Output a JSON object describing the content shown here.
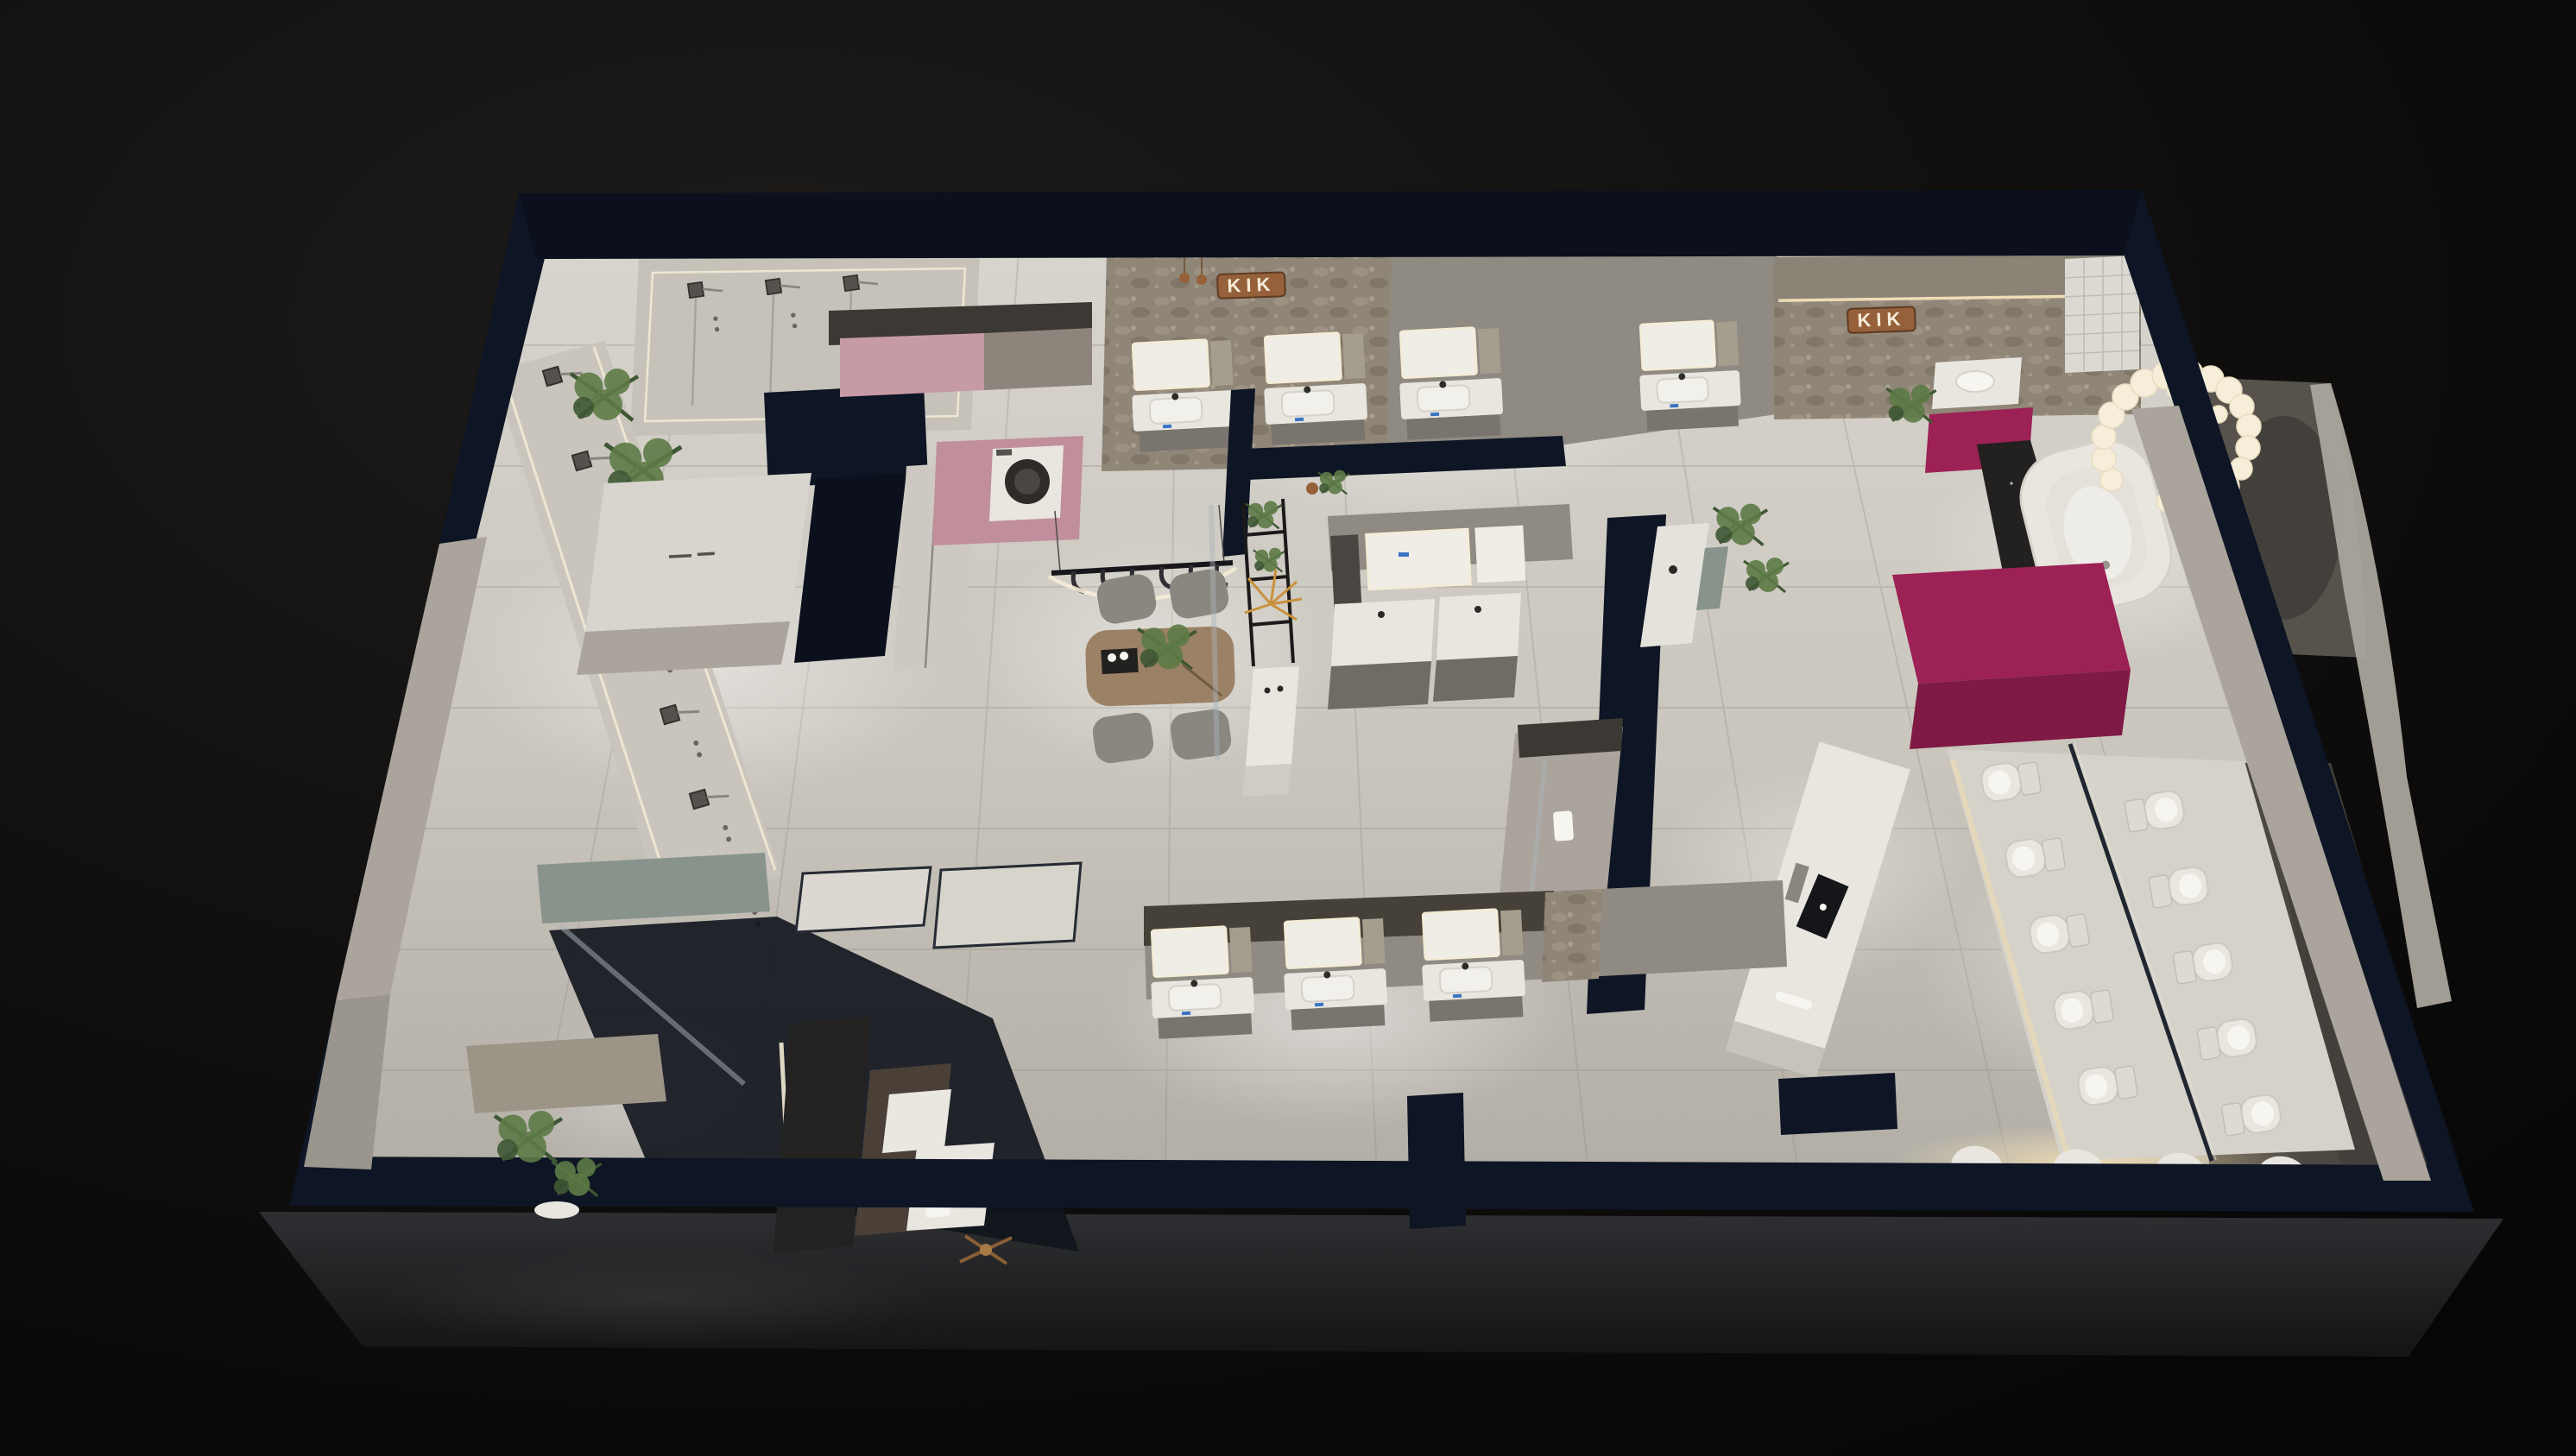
{
  "scene": {
    "title": "3D dollhouse-view render of a KIK bathroom-fixtures showroom",
    "style": "photorealistic top-down interior render, dark night surround",
    "brand": "KIK"
  },
  "branding": {
    "logo_text": "KIK",
    "plaques": [
      {
        "location": "top-center travertine feature wall",
        "material": "copper"
      },
      {
        "location": "right-wing travertine wall above bathtub area",
        "material": "copper"
      }
    ]
  },
  "colors": {
    "navy": "#0e1524",
    "navy2": "#0b101c",
    "wallLight": "#aaa49c",
    "wallMid": "#8f8a82",
    "wallDark": "#3c3833",
    "stone": "#8f8678",
    "white": "#e9e6e0",
    "whiteBright": "#f7f5f0",
    "mirror": "#efede6",
    "mat": "#4b4741",
    "magenta": "#9c2154",
    "magentaDark": "#7e1a44",
    "pink": "#c79ba6",
    "copper": "#95603a",
    "logoText": "#f5ecd9",
    "wood": "#9b8166",
    "chair": "#8a8781",
    "green": "#5d7a46",
    "greenD": "#3e5733",
    "palm": "#c8913c",
    "teal": "#87938b",
    "screen": "#15161a",
    "tag": "#3b74c4",
    "led": "#f5ecd6",
    "glass": "#aab4b8",
    "tileLine": "#8e897f",
    "floor": "#cfccc4",
    "apron": "#27282a",
    "ground": "#0d0d0c"
  },
  "zones": [
    {
      "id": "zone-shower-display",
      "label": "shower & faucet display walls"
    },
    {
      "id": "zone-reception",
      "label": "reception desk"
    },
    {
      "id": "zone-laundry",
      "label": "laundry nook with washing machine"
    },
    {
      "id": "zone-stone-wall-vanities",
      "label": "vanity row on travertine wall"
    },
    {
      "id": "zone-dining-table",
      "label": "wood consult table with faucet rail"
    },
    {
      "id": "zone-vanity-islands",
      "label": "center vanity islands"
    },
    {
      "id": "zone-consult-island",
      "label": "white display island with screen"
    },
    {
      "id": "zone-bathtub",
      "label": "freestanding tub with bulb chandelier"
    },
    {
      "id": "zone-toilet-platform",
      "label": "smart-toilet display platform"
    },
    {
      "id": "zone-bottom-vanities",
      "label": "lower vanity display row"
    },
    {
      "id": "zone-bath-rooms",
      "label": "mock bathroom rooms, lower left"
    },
    {
      "id": "zone-entrance",
      "label": "entrance planter, lower left corner"
    }
  ],
  "fixtures": {
    "toilets_on_platform": 10,
    "toilets_on_bottom_wall": 4,
    "shower_sets_left_wall": 7,
    "shower_columns_top_wall": 3,
    "vanity_units_total": 12,
    "chandelier_bulbs": 20,
    "dining_chairs": 4,
    "hanging_faucets_on_rail": 6,
    "washing_machines": 1,
    "bathtubs": 1,
    "plants": 8
  }
}
